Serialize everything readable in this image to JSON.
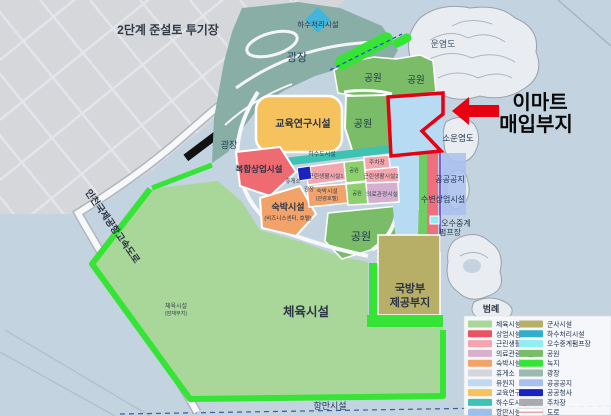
{
  "callout": {
    "line1": "이마트",
    "line2": "매입부지"
  },
  "colors": {
    "accent_red": "#e60012",
    "site_fill": "#b8dbf4",
    "sea": "#c3d3e0",
    "park_green": "#7abc67",
    "greenery": "#35e435",
    "sports_green": "#a8d799",
    "education_orange": "#f5c25e",
    "commercial_red": "#ee6b72",
    "teal_plaza": "#88aea6"
  },
  "map_labels": [
    {
      "name": "dredge-site",
      "text": "2단계 준설토 투기장",
      "x": 168,
      "y": 34,
      "size": 12,
      "weight": "bold",
      "color": "#333a47"
    },
    {
      "name": "sewage-treatment",
      "text": "하수처리시설",
      "x": 318,
      "y": 27,
      "size": 7.5,
      "color": "#1e3550"
    },
    {
      "name": "unyeomdo",
      "text": "운염도",
      "x": 443,
      "y": 47,
      "size": 9,
      "color": "#46566a"
    },
    {
      "name": "plaza-main",
      "text": "광장",
      "x": 297,
      "y": 61,
      "size": 11,
      "color": "#1d3b52"
    },
    {
      "name": "park-top-1",
      "text": "공원",
      "x": 373,
      "y": 81,
      "size": 9.5,
      "color": "#1e3550"
    },
    {
      "name": "park-top-2",
      "text": "공원",
      "x": 416,
      "y": 83,
      "size": 9.5,
      "color": "#1e3550"
    },
    {
      "name": "park-east",
      "text": "공원",
      "x": 363,
      "y": 127,
      "size": 10,
      "color": "#1e3550"
    },
    {
      "name": "education",
      "text": "교육연구시설",
      "x": 303,
      "y": 127,
      "size": 10,
      "weight": "bold",
      "color": "#2c3444"
    },
    {
      "name": "sounyeomdo",
      "text": "소운염도",
      "x": 458,
      "y": 141,
      "size": 8.5,
      "color": "#1e3550"
    },
    {
      "name": "plaza-west",
      "text": "광장",
      "x": 229,
      "y": 148,
      "size": 9,
      "color": "#1d3b52"
    },
    {
      "name": "sewer-band",
      "text": "하수도시설",
      "x": 322,
      "y": 156,
      "size": 6,
      "color": "#0e3f4a"
    },
    {
      "name": "commercial-complex",
      "text": "복합상업시설",
      "x": 259,
      "y": 172,
      "size": 8.5,
      "weight": "bold",
      "color": "#2c3444"
    },
    {
      "name": "neighborhood-1",
      "text": "근린생활시설1",
      "x": 326,
      "y": 178,
      "size": 5.8,
      "color": "#38404e"
    },
    {
      "name": "parking",
      "text": "주차장",
      "x": 377,
      "y": 164,
      "size": 5.8,
      "color": "#38404e"
    },
    {
      "name": "neighborhood-2",
      "text": "근린생활시설2",
      "x": 381,
      "y": 178,
      "size": 5.8,
      "color": "#38404e"
    },
    {
      "name": "rest-area",
      "text": "휴게소",
      "x": 293,
      "y": 183,
      "size": 5.5,
      "color": "#38404e"
    },
    {
      "name": "plaza-small",
      "text": "광장",
      "x": 309,
      "y": 191,
      "size": 5.5,
      "color": "#38404e"
    },
    {
      "name": "hotel-tour-1",
      "text": "숙박시설",
      "x": 327,
      "y": 193,
      "size": 5.8,
      "color": "#38404e"
    },
    {
      "name": "hotel-tour-2",
      "text": "(관광호텔)",
      "x": 327,
      "y": 200,
      "size": 5.2,
      "color": "#38404e"
    },
    {
      "name": "park-mini-1",
      "text": "공원",
      "x": 354,
      "y": 172,
      "size": 5.2,
      "color": "#2b4a33"
    },
    {
      "name": "park-mini-2",
      "text": "공원",
      "x": 357,
      "y": 195,
      "size": 5.2,
      "color": "#2b4a33"
    },
    {
      "name": "medical-tourism",
      "text": "의료관광시설",
      "x": 382,
      "y": 196,
      "size": 5.8,
      "color": "#38404e"
    },
    {
      "name": "hotel-biz-1",
      "text": "숙박시설",
      "x": 288,
      "y": 210,
      "size": 9,
      "weight": "bold",
      "color": "#2c3444"
    },
    {
      "name": "hotel-biz-2",
      "text": "(비즈니스센터, 호텔)",
      "x": 288,
      "y": 220,
      "size": 5.5,
      "color": "#2c3444"
    },
    {
      "name": "park-mid",
      "text": "공원",
      "x": 361,
      "y": 240,
      "size": 11,
      "color": "#1e3550"
    },
    {
      "name": "public-open-space",
      "text": "공공공지",
      "x": 450,
      "y": 182,
      "size": 8,
      "color": "#1e3550"
    },
    {
      "name": "waterfront-commercial",
      "text": "수변상업시설",
      "x": 443,
      "y": 202,
      "size": 8,
      "color": "#1e3550"
    },
    {
      "name": "pump-station-1",
      "text": "오수중계",
      "x": 456,
      "y": 226,
      "size": 8,
      "color": "#1e3550"
    },
    {
      "name": "pump-station-2",
      "text": "펌프장",
      "x": 450,
      "y": 235,
      "size": 8,
      "color": "#1e3550"
    },
    {
      "name": "defense-1",
      "text": "국방부",
      "x": 410,
      "y": 292,
      "size": 11,
      "weight": "bold",
      "color": "#2c3444"
    },
    {
      "name": "defense-2",
      "text": "제공부지",
      "x": 410,
      "y": 306,
      "size": 11,
      "weight": "bold",
      "color": "#2c3444"
    },
    {
      "name": "sports-small-1",
      "text": "체육시설",
      "x": 176,
      "y": 308,
      "size": 6,
      "color": "#38404e"
    },
    {
      "name": "sports-small-2",
      "text": "(잠재부지)",
      "x": 176,
      "y": 315,
      "size": 5.2,
      "color": "#38404e"
    },
    {
      "name": "sports-big",
      "text": "체육시설",
      "x": 306,
      "y": 316,
      "size": 12.5,
      "weight": "bold",
      "color": "#2c3444"
    },
    {
      "name": "expressway",
      "text": "인천국제공항고속도로",
      "x": 110,
      "y": 228,
      "size": 9.5,
      "weight": "bold",
      "color": "#2c3444",
      "rotate": 55
    },
    {
      "name": "port",
      "text": "항만시설",
      "x": 330,
      "y": 409,
      "size": 9,
      "color": "#1e3550"
    }
  ],
  "legend": {
    "title": "범례",
    "columns": [
      {
        "items": [
          {
            "label": "체육시설",
            "color": "#a8d799"
          },
          {
            "label": "상업시설",
            "color": "#e85560"
          },
          {
            "label": "근린생활시설",
            "color": "#f4a6ae"
          },
          {
            "label": "의료관광시설",
            "color": "#d9b0cc"
          },
          {
            "label": "숙박시설",
            "color": "#f2a369"
          },
          {
            "label": "휴게소",
            "color": "#d3d6dd"
          },
          {
            "label": "유원지",
            "color": "#c3d9f0"
          },
          {
            "label": "교육연구시설",
            "color": "#f5c25e"
          },
          {
            "label": "하수도시설",
            "color": "#3ec3b3"
          },
          {
            "label": "항만시설",
            "color": "#9dc0e8"
          }
        ]
      },
      {
        "items": [
          {
            "label": "군사시설",
            "color": "#b7ae68"
          },
          {
            "label": "하수처리시설",
            "color": "#31aecb"
          },
          {
            "label": "오수중계펌프장",
            "color": "#8feef2"
          },
          {
            "label": "공원",
            "color": "#7abc67"
          },
          {
            "label": "녹지",
            "color": "#35e435"
          },
          {
            "label": "광장",
            "color": "#9db8ae"
          },
          {
            "label": "공공공지",
            "color": "#a9c0ee"
          },
          {
            "label": "공공청사",
            "color": "#1a22c0"
          },
          {
            "label": "주차장",
            "color": "#a9abb0"
          },
          {
            "label": "도로",
            "color": "#ffffff",
            "stripe": "#e88888"
          }
        ]
      }
    ]
  }
}
